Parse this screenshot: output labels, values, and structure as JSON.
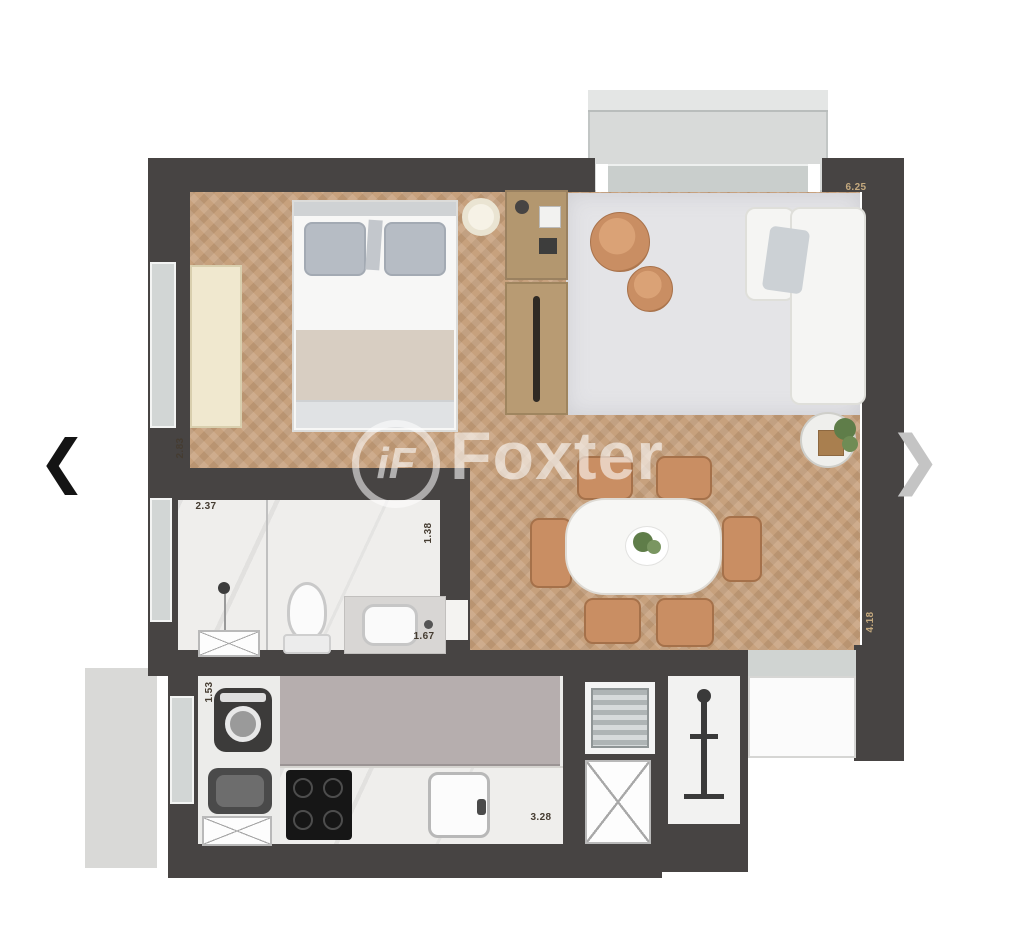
{
  "carousel": {
    "prev_icon_glyph": "❮",
    "next_icon_glyph": "❯"
  },
  "watermark": {
    "monogram": "iF",
    "brand": "Foxter"
  },
  "floorplan": {
    "dimensions": {
      "living_top": "6.25",
      "bedroom_side": "2.83",
      "bathroom_top": "2.37",
      "bathroom_right": "1.38",
      "bathroom_bottom": "1.67",
      "laundry_side": "1.53",
      "kitchen_bottom": "3.28",
      "living_right": "4.18"
    },
    "colors": {
      "wall": "#474443",
      "wood": "#c7a17d",
      "rug": "#e4e4e7",
      "marble": "#efeeec",
      "island": "#b6aeae",
      "balcony": "#d8dad9",
      "tan": "#c98e63",
      "cream": "#f0e8cf",
      "appliance-dark": "#3c3b3a",
      "plant": "#5f7d49",
      "dim-dark": "#453c31",
      "dim-light": "#c4a97e"
    }
  }
}
